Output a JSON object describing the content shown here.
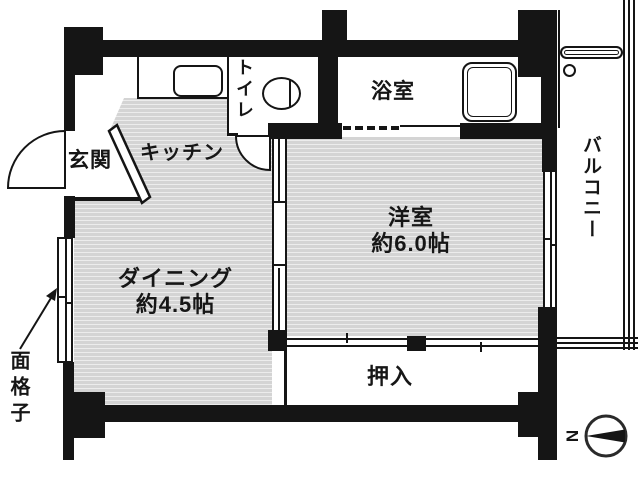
{
  "rooms": {
    "genkan": {
      "label": "玄関"
    },
    "kitchen": {
      "label": "キッチン"
    },
    "toilet": {
      "label": "トイレ"
    },
    "bathroom": {
      "label": "浴室"
    },
    "western_room": {
      "label": "洋室",
      "size": "約6.0帖"
    },
    "dining": {
      "label": "ダイニング",
      "size": "約4.5帖"
    },
    "closet": {
      "label": "押入"
    },
    "balcony": {
      "label": "バルコニー"
    }
  },
  "annotations": {
    "window_lattice": {
      "label": "面格子"
    },
    "compass": {
      "north_label": "N"
    }
  },
  "colors": {
    "wall": "#151515",
    "floor_fill": "#d4d4d4",
    "floor_stripe": "#ececec",
    "background": "#ffffff"
  }
}
